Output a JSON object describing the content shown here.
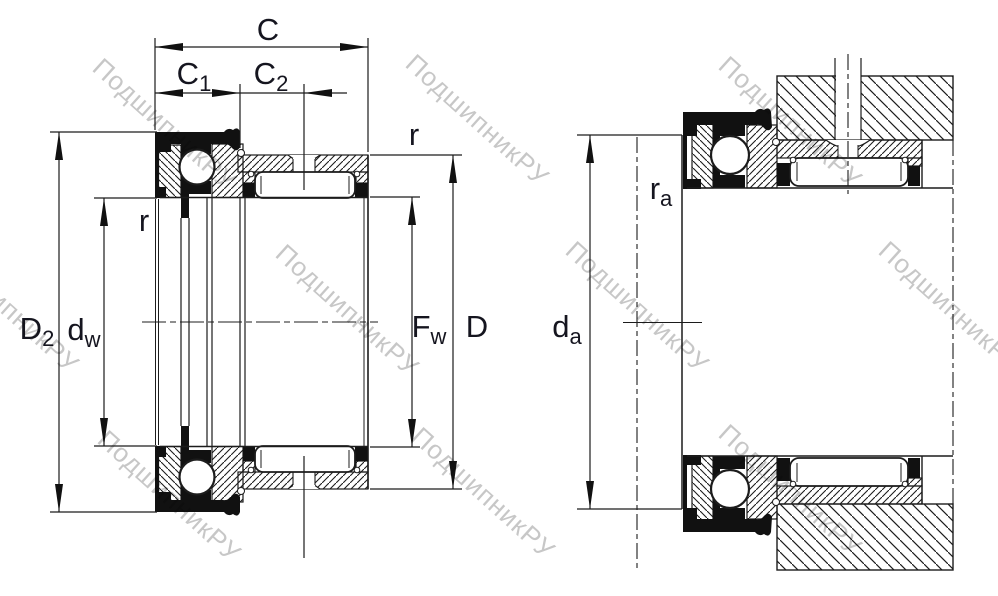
{
  "watermark": {
    "text": "ПодшипникРУ"
  },
  "colors": {
    "line": "#1c1c1c",
    "fill_black": "#111111",
    "text": "#15151f",
    "watermark": "#c7c7c7",
    "background": "#ffffff"
  },
  "labels": {
    "c": "C",
    "c1": {
      "base": "C",
      "sub": "1"
    },
    "c2": {
      "base": "C",
      "sub": "2"
    },
    "r_outer": "r",
    "r_left": "r",
    "d2": {
      "base": "D",
      "sub": "2"
    },
    "dw": {
      "base": "d",
      "sub": "w"
    },
    "fw": {
      "base": "F",
      "sub": "w"
    },
    "d": "D",
    "da": {
      "base": "d",
      "sub": "a"
    },
    "ra": {
      "base": "r",
      "sub": "a"
    }
  }
}
